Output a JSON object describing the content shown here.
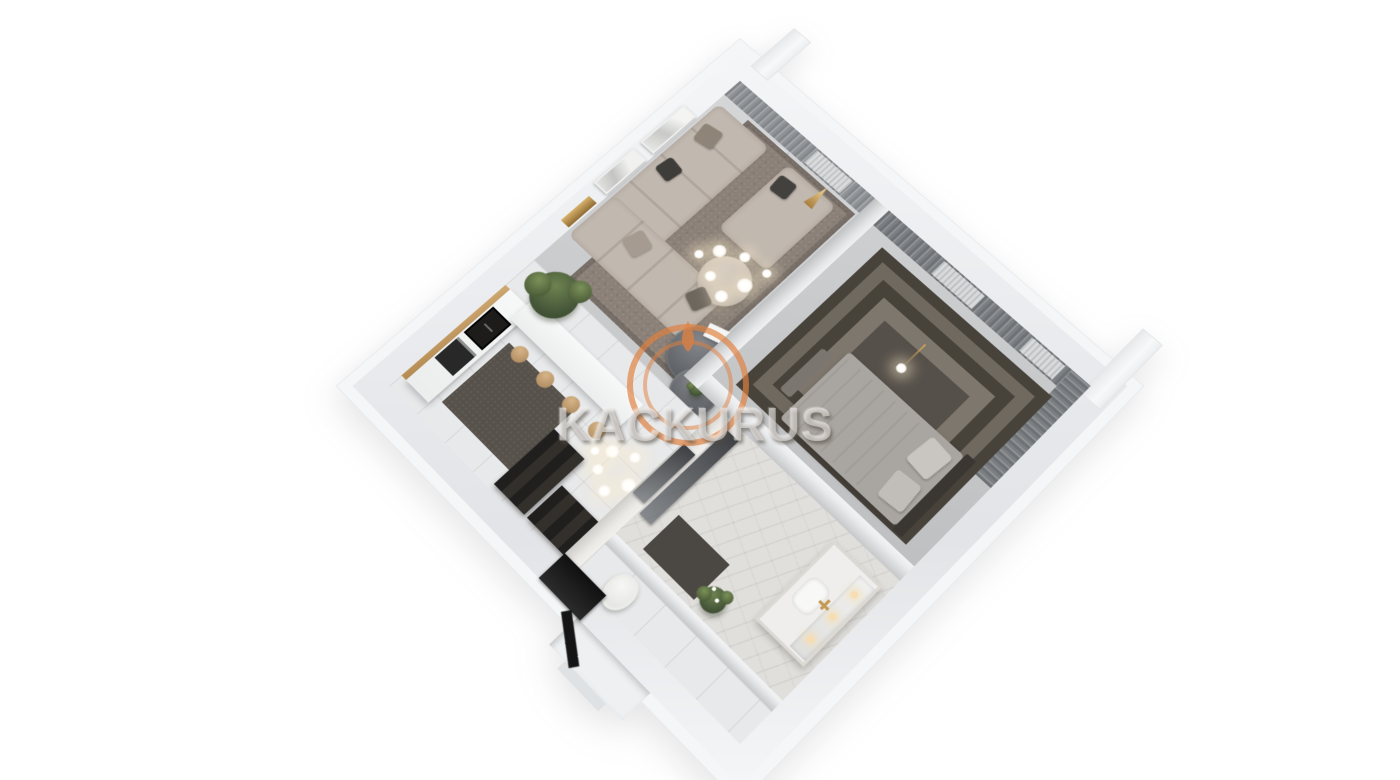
{
  "watermark": {
    "text": "KACKURUS",
    "logo": "double-ring-flame-icon",
    "logo_color": "#e0813f"
  },
  "palette": {
    "accent_orange": "#e0813f",
    "wall_fill": "#e9ebee",
    "wall_rim": "#f5f6f8",
    "floor_living": "#c8c9cb",
    "floor_hall": "#e8e9ea",
    "rug_living": "#8b8178",
    "rug_dark": "#55504a",
    "sofa": "#c1b8af",
    "curtain": "#84878a",
    "curtain_dark": "#6f7275",
    "wood": "#cfa871",
    "marble": "#e1dfdc",
    "black": "#1d1c1b",
    "watermark_text": "rgba(236,234,231,0.55)"
  }
}
